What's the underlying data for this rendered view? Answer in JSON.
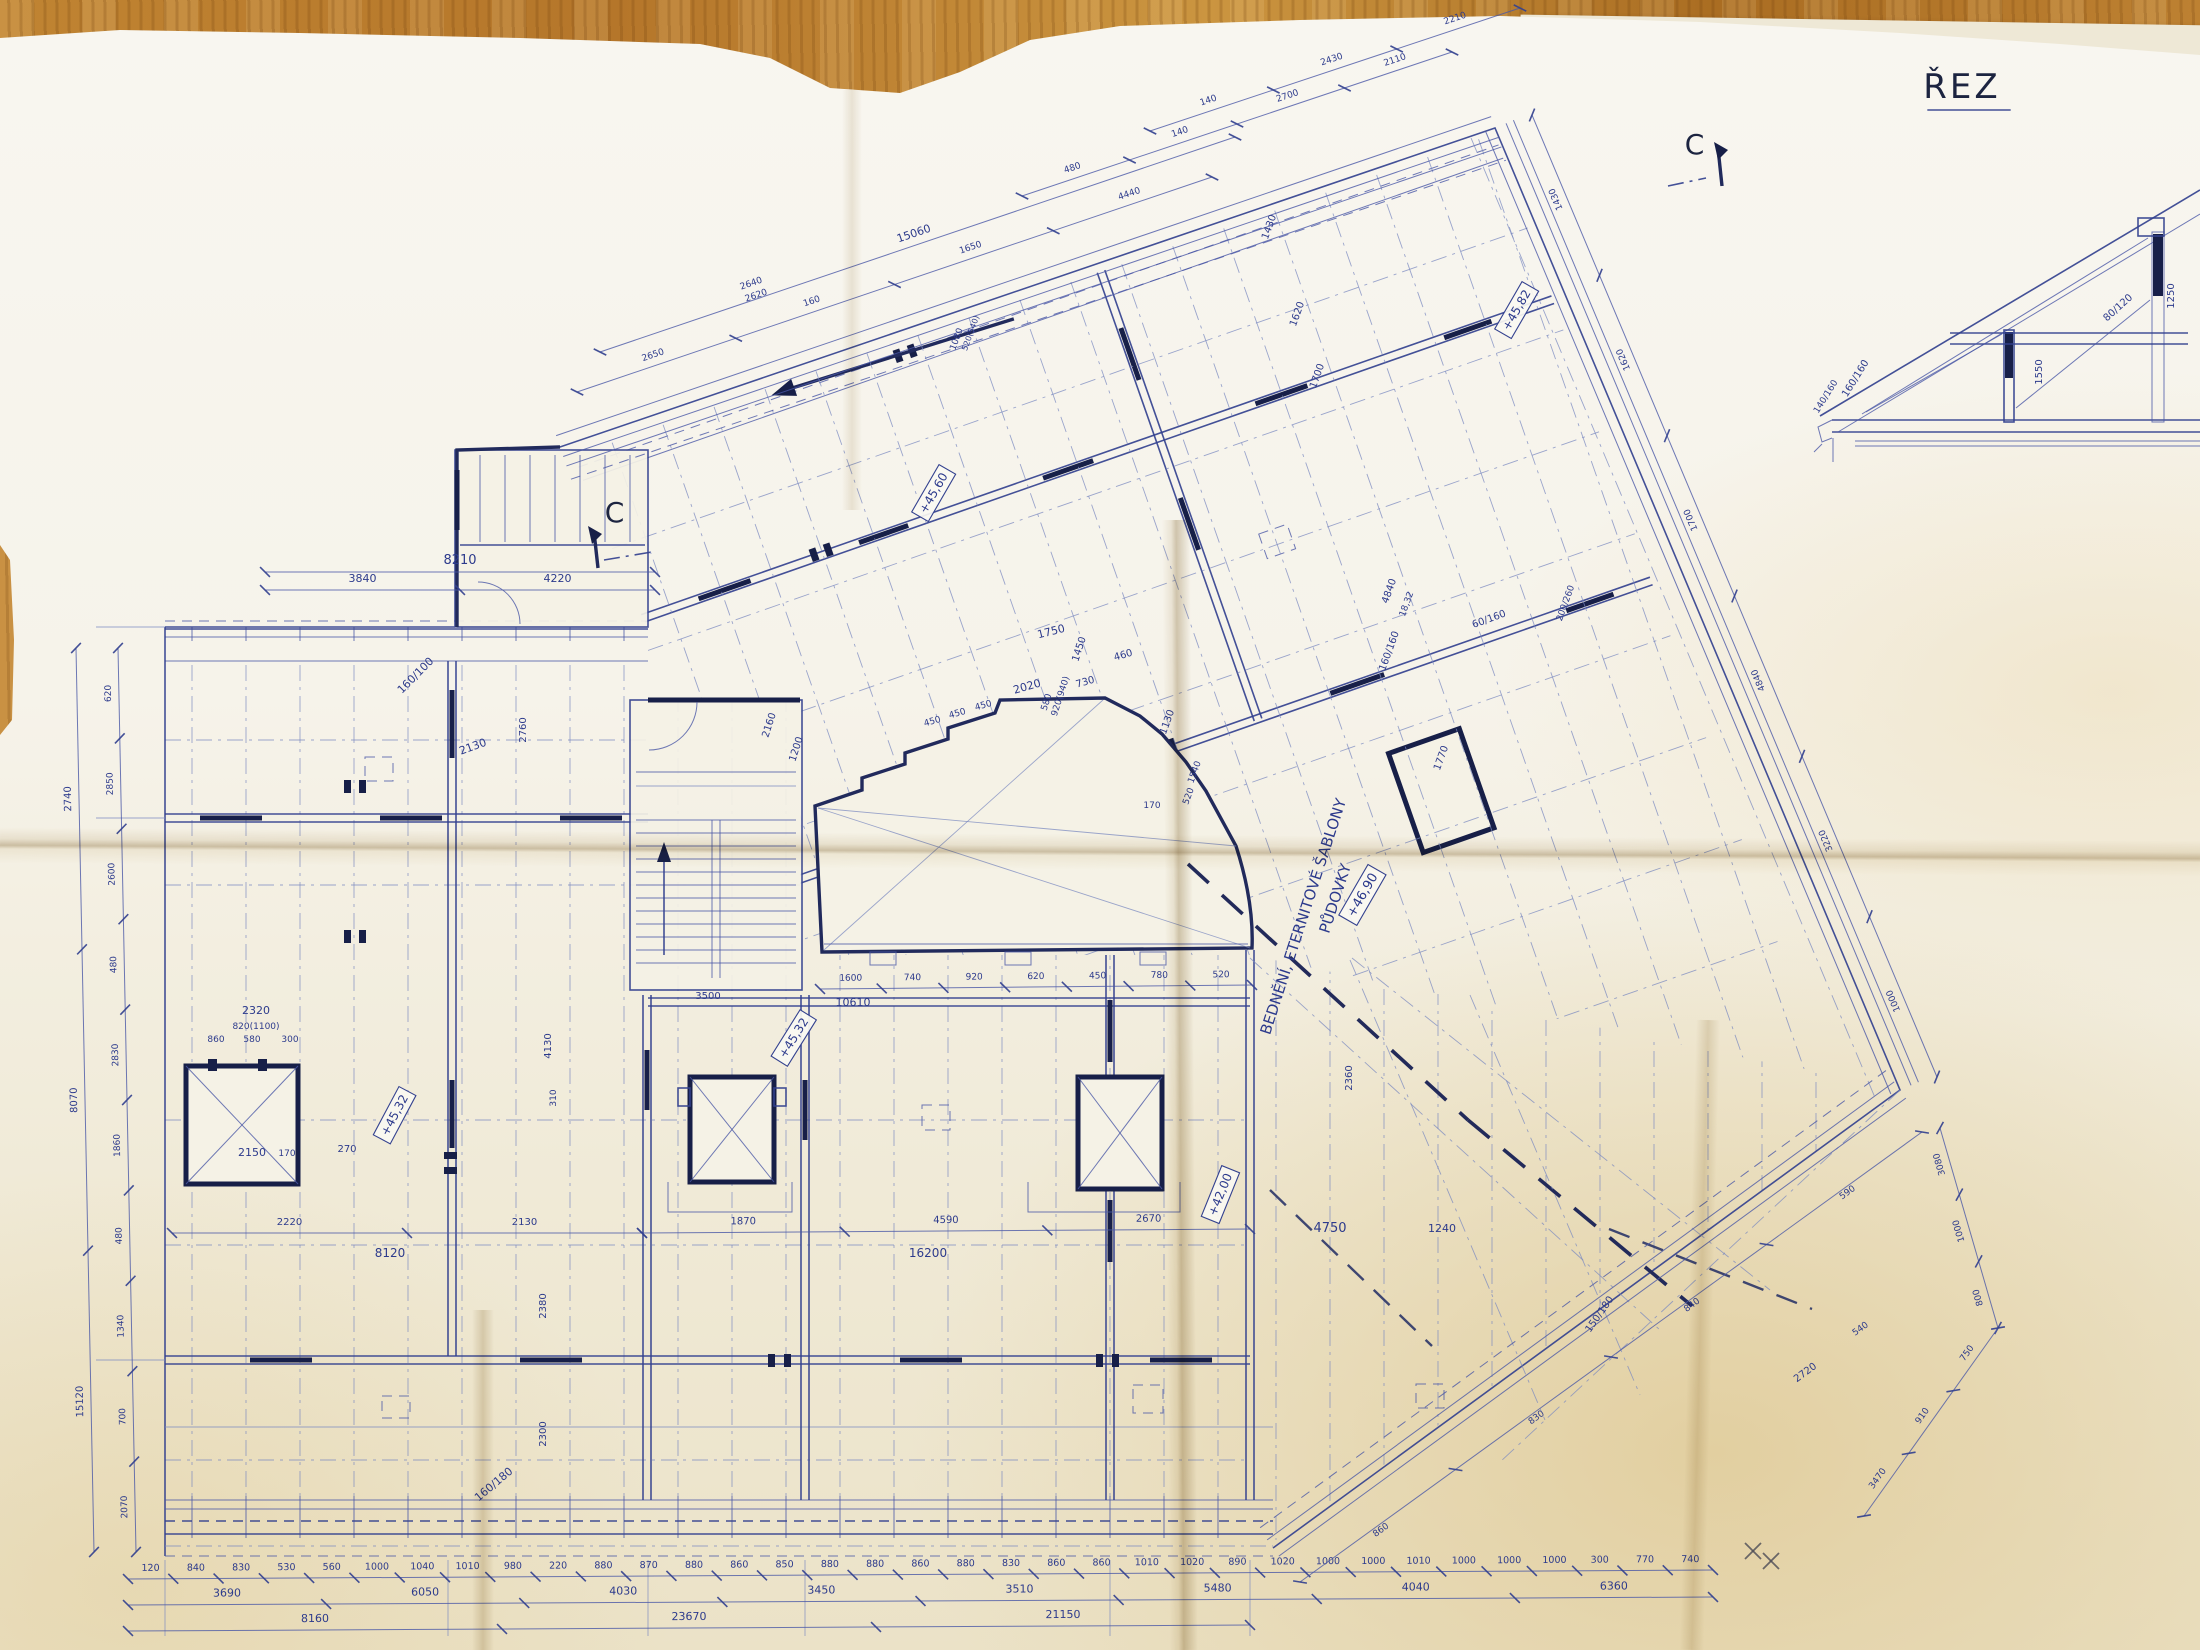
{
  "document": {
    "kind": "photograph of a hand-drawn roof framing plan (blueprint) on a wooden table",
    "title_section": "ŘEZ",
    "section_marker": "C",
    "note_line1": "BEDNĚNÍ, ETERNITOVÉ ŠABLONY",
    "note_line2": "PŮDOVKY",
    "colors": {
      "ink": "#33418f",
      "dark_ink": "#1e2757",
      "pencil": "#4a4a55",
      "paper": "#f5f2e7",
      "wood": "#bc8030"
    }
  },
  "labels": [
    {
      "t": "ŘEZ",
      "x": 1962,
      "y": 98,
      "r": 0,
      "s": 34,
      "c": "dark",
      "u": true
    },
    {
      "t": "C",
      "x": 616,
      "y": 522,
      "r": 0,
      "s": 28,
      "c": "dark"
    },
    {
      "t": "C",
      "x": 1696,
      "y": 154,
      "r": 0,
      "s": 28,
      "c": "dark"
    },
    {
      "t": "BEDNĚNÍ, ETERNITOVÉ ŠABLONY",
      "x": 1308,
      "y": 918,
      "r": -72,
      "s": 15
    },
    {
      "t": "PŮDOVKY",
      "x": 1340,
      "y": 900,
      "r": -72,
      "s": 15
    },
    {
      "t": "+46,90",
      "x": 1366,
      "y": 897,
      "r": -60,
      "s": 13,
      "box": true
    },
    {
      "t": "+45,32",
      "x": 398,
      "y": 1117,
      "r": -62,
      "s": 12,
      "box": true
    },
    {
      "t": "+45,32",
      "x": 797,
      "y": 1040,
      "r": -58,
      "s": 12,
      "box": true
    },
    {
      "t": "+45,82",
      "x": 1520,
      "y": 312,
      "r": -60,
      "s": 12,
      "box": true
    },
    {
      "t": "+45,60",
      "x": 937,
      "y": 495,
      "r": -60,
      "s": 12,
      "box": true
    },
    {
      "t": "+42,00",
      "x": 1224,
      "y": 1196,
      "r": -68,
      "s": 12,
      "box": true
    },
    {
      "t": "160/100",
      "x": 418,
      "y": 678,
      "r": -45,
      "s": 11
    },
    {
      "t": "160/160",
      "x": 1392,
      "y": 652,
      "r": -70,
      "s": 10
    },
    {
      "t": "60/160",
      "x": 1490,
      "y": 622,
      "r": -20,
      "s": 10
    },
    {
      "t": "200/260",
      "x": 1568,
      "y": 604,
      "r": -70,
      "s": 9
    },
    {
      "t": "160/180",
      "x": 496,
      "y": 1487,
      "r": -40,
      "s": 11
    },
    {
      "t": "150/180",
      "x": 1602,
      "y": 1316,
      "r": -55,
      "s": 10
    },
    {
      "t": "160/160",
      "x": 1858,
      "y": 380,
      "r": -58,
      "s": 10
    },
    {
      "t": "1550",
      "x": 2042,
      "y": 372,
      "r": -90,
      "s": 10
    },
    {
      "t": "80/120",
      "x": 2120,
      "y": 310,
      "r": -42,
      "s": 10
    },
    {
      "t": "1250",
      "x": 2174,
      "y": 296,
      "r": -90,
      "s": 10
    },
    {
      "t": "140/160",
      "x": 1828,
      "y": 398,
      "r": -58,
      "s": 9
    },
    {
      "t": "2130",
      "x": 474,
      "y": 750,
      "r": -20,
      "s": 11
    },
    {
      "t": "2760",
      "x": 526,
      "y": 730,
      "r": -90,
      "s": 10
    },
    {
      "t": "1200",
      "x": 799,
      "y": 750,
      "r": -72,
      "s": 10
    },
    {
      "t": "2160",
      "x": 772,
      "y": 726,
      "r": -72,
      "s": 10
    },
    {
      "t": "1750",
      "x": 1052,
      "y": 635,
      "r": -14,
      "s": 11
    },
    {
      "t": "1450",
      "x": 1082,
      "y": 650,
      "r": -72,
      "s": 10
    },
    {
      "t": "2020",
      "x": 1028,
      "y": 690,
      "r": -16,
      "s": 11
    },
    {
      "t": "450",
      "x": 933,
      "y": 724,
      "r": -16,
      "s": 9
    },
    {
      "t": "450",
      "x": 958,
      "y": 716,
      "r": -16,
      "s": 9
    },
    {
      "t": "450",
      "x": 984,
      "y": 708,
      "r": -16,
      "s": 9
    },
    {
      "t": "580",
      "x": 1049,
      "y": 703,
      "r": -72,
      "s": 9
    },
    {
      "t": "920(940)",
      "x": 1063,
      "y": 697,
      "r": -72,
      "s": 9
    },
    {
      "t": "730",
      "x": 1086,
      "y": 685,
      "r": -16,
      "s": 10
    },
    {
      "t": "460",
      "x": 1124,
      "y": 658,
      "r": -16,
      "s": 10
    },
    {
      "t": "1130",
      "x": 1170,
      "y": 723,
      "r": -70,
      "s": 10
    },
    {
      "t": "1540",
      "x": 1197,
      "y": 773,
      "r": -70,
      "s": 9
    },
    {
      "t": "520",
      "x": 1191,
      "y": 797,
      "r": -70,
      "s": 9
    },
    {
      "t": "170",
      "x": 1152,
      "y": 808,
      "r": 0,
      "s": 9
    },
    {
      "t": "10610",
      "x": 853,
      "y": 1006,
      "r": 0,
      "s": 11
    },
    {
      "t": "8120",
      "x": 390,
      "y": 1257,
      "r": 0,
      "s": 12
    },
    {
      "t": "16200",
      "x": 928,
      "y": 1257,
      "r": 0,
      "s": 12
    },
    {
      "t": "2320",
      "x": 256,
      "y": 1014,
      "r": 0,
      "s": 11
    },
    {
      "t": "820(1100)",
      "x": 256,
      "y": 1029,
      "r": 0,
      "s": 9
    },
    {
      "t": "860",
      "x": 216,
      "y": 1042,
      "r": 0,
      "s": 9
    },
    {
      "t": "580",
      "x": 252,
      "y": 1042,
      "r": 0,
      "s": 9
    },
    {
      "t": "300",
      "x": 290,
      "y": 1042,
      "r": 0,
      "s": 9
    },
    {
      "t": "2150",
      "x": 252,
      "y": 1156,
      "r": 0,
      "s": 11
    },
    {
      "t": "170",
      "x": 287,
      "y": 1156,
      "r": 0,
      "s": 9
    },
    {
      "t": "270",
      "x": 347,
      "y": 1152,
      "r": 0,
      "s": 10
    },
    {
      "t": "3500",
      "x": 708,
      "y": 999,
      "r": 0,
      "s": 10
    },
    {
      "t": "4130",
      "x": 551,
      "y": 1046,
      "r": -90,
      "s": 10
    },
    {
      "t": "310",
      "x": 556,
      "y": 1098,
      "r": -90,
      "s": 9
    },
    {
      "t": "2380",
      "x": 546,
      "y": 1306,
      "r": -90,
      "s": 10
    },
    {
      "t": "2300",
      "x": 546,
      "y": 1434,
      "r": -90,
      "s": 10
    },
    {
      "t": "4750",
      "x": 1330,
      "y": 1232,
      "r": 0,
      "s": 13
    },
    {
      "t": "1240",
      "x": 1442,
      "y": 1232,
      "r": 0,
      "s": 11
    },
    {
      "t": "1080",
      "x": 959,
      "y": 340,
      "r": -70,
      "s": 9
    },
    {
      "t": "520(540)",
      "x": 973,
      "y": 334,
      "r": -70,
      "s": 8
    },
    {
      "t": "2640",
      "x": 752,
      "y": 286,
      "r": -19,
      "s": 9
    },
    {
      "t": "2620",
      "x": 757,
      "y": 298,
      "r": -19,
      "s": 9
    },
    {
      "t": "1430",
      "x": 1272,
      "y": 228,
      "r": -70,
      "s": 10
    },
    {
      "t": "1620",
      "x": 1300,
      "y": 315,
      "r": -70,
      "s": 10
    },
    {
      "t": "1700",
      "x": 1320,
      "y": 377,
      "r": -70,
      "s": 10
    },
    {
      "t": "4840",
      "x": 1392,
      "y": 592,
      "r": -70,
      "s": 10
    },
    {
      "t": "18,32",
      "x": 1409,
      "y": 605,
      "r": -70,
      "s": 9
    },
    {
      "t": "1770",
      "x": 1444,
      "y": 759,
      "r": -70,
      "s": 10
    },
    {
      "t": "2720",
      "x": 1807,
      "y": 1375,
      "r": -36,
      "s": 10
    },
    {
      "t": "540",
      "x": 1862,
      "y": 1331,
      "r": -36,
      "s": 9
    },
    {
      "t": "2360",
      "x": 1352,
      "y": 1078,
      "r": -90,
      "s": 10
    }
  ],
  "chains": [
    {
      "v": [
        "120",
        "840",
        "830",
        "530",
        "560",
        "1000",
        "1040",
        "1010",
        "980",
        "220",
        "880",
        "870",
        "880",
        "860",
        "850",
        "880",
        "880",
        "860",
        "880",
        "830",
        "860",
        "860",
        "1010",
        "1020",
        "890",
        "1020",
        "1000",
        "1000",
        "1010",
        "1000",
        "1000",
        "1000",
        "300",
        "770",
        "740"
      ],
      "p": [
        128,
        1579,
        1713,
        1570
      ],
      "s": 9.5
    },
    {
      "v": [
        "3690",
        "6050",
        "4030",
        "3450",
        "3510",
        "5480",
        "4040",
        "6360"
      ],
      "p": [
        128,
        1605,
        1713,
        1597
      ],
      "s": 11
    },
    {
      "v": [
        "8160",
        "23670",
        "21150"
      ],
      "p": [
        128,
        1631,
        1250,
        1625
      ],
      "s": 11
    },
    {
      "v": [
        "2740",
        "8070",
        "15120"
      ],
      "p": [
        76,
        648,
        94,
        1552
      ],
      "s": 10
    },
    {
      "v": [
        "620",
        "2850",
        "2600",
        "480",
        "2830",
        "1860",
        "480",
        "1340",
        "700",
        "2070"
      ],
      "p": [
        118,
        648,
        136,
        1552
      ],
      "s": 9
    },
    {
      "v": [
        "2650",
        "160",
        "1650",
        "4440"
      ],
      "p": [
        577,
        392,
        1212,
        177
      ],
      "s": 9
    },
    {
      "v": [
        "15060"
      ],
      "p": [
        600,
        352,
        1235,
        137
      ],
      "s": 11
    },
    {
      "v": [
        "480",
        "140",
        "2700",
        "2110"
      ],
      "p": [
        1022,
        196,
        1452,
        52
      ],
      "s": 9
    },
    {
      "v": [
        "140",
        "2430",
        "2210"
      ],
      "p": [
        1150,
        131,
        1520,
        8
      ],
      "s": 9
    },
    {
      "v": [
        "1430",
        "1620",
        "1700",
        "4840",
        "3220",
        "1000"
      ],
      "p": [
        1532,
        115,
        1937,
        1077
      ],
      "s": 9
    },
    {
      "v": [
        "3080",
        "1000",
        "800"
      ],
      "p": [
        1940,
        1128,
        1998,
        1328
      ],
      "s": 9
    },
    {
      "v": [
        "750",
        "910",
        "3470"
      ],
      "p": [
        1998,
        1328,
        1864,
        1516
      ],
      "s": 9
    },
    {
      "v": [
        "590",
        "840",
        "830",
        "860"
      ],
      "p": [
        1922,
        1132,
        1300,
        1582
      ],
      "s": 9
    },
    {
      "v": [
        "8210"
      ],
      "p": [
        265,
        572,
        655,
        572
      ],
      "s": 13
    },
    {
      "v": [
        "3840",
        "4220"
      ],
      "p": [
        265,
        590,
        655,
        590
      ],
      "s": 11
    },
    {
      "v": [
        "1600",
        "740",
        "920",
        "620",
        "450",
        "780",
        "520"
      ],
      "p": [
        820,
        989,
        1252,
        985
      ],
      "s": 9
    },
    {
      "v": [
        "2220",
        "2130"
      ],
      "p": [
        172,
        1233,
        642,
        1233
      ],
      "s": 10
    },
    {
      "v": [
        "1870",
        "4590",
        "2670"
      ],
      "p": [
        642,
        1233,
        1250,
        1229
      ],
      "s": 10
    }
  ]
}
